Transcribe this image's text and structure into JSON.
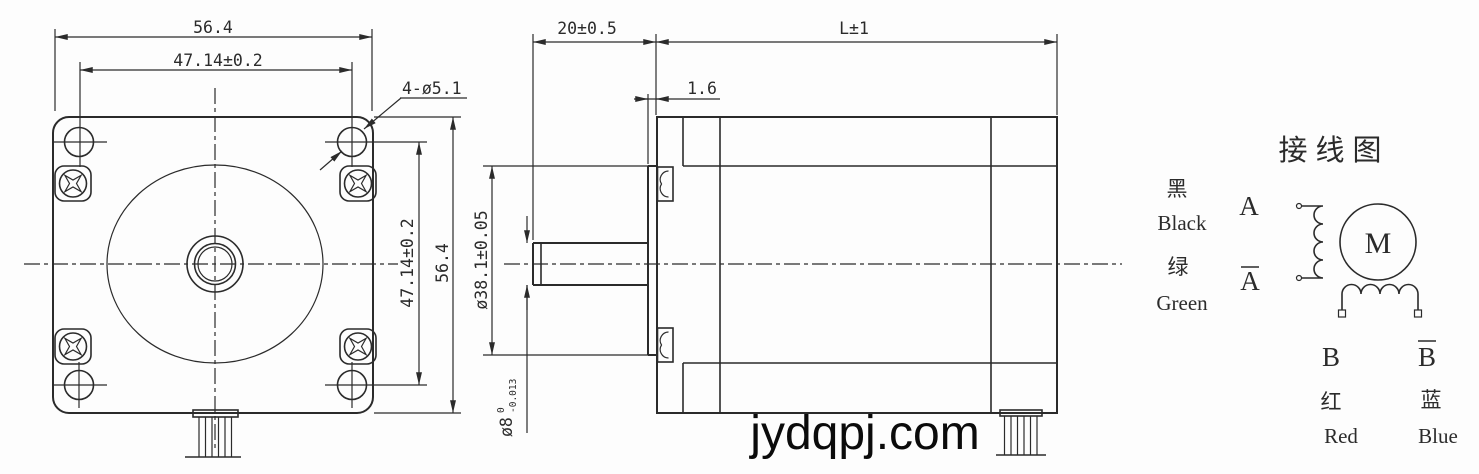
{
  "colors": {
    "line": "#2b2b2b",
    "background": "#fdfdfd",
    "watermark": "#0b0b0b"
  },
  "watermark": "jydqpj.com",
  "front_view": {
    "dim_top_outer": "56.4",
    "dim_top_holes": "47.14±0.2",
    "label_holes": "4-ø5.1",
    "dim_right_holes": "47.14±0.2",
    "dim_right_outer": "56.4"
  },
  "side_view": {
    "dim_shaft_length": "20±0.5",
    "dim_body_length": "L±1",
    "dim_boss_height": "1.6",
    "dim_boss_dia": "ø38.1±0.05",
    "dim_shaft_dia": "ø8",
    "shaft_tol_upper": "0",
    "shaft_tol_lower": "-0.013"
  },
  "wiring": {
    "title": "接线图",
    "motor": "M",
    "terminals": {
      "a": {
        "phase": "A",
        "wire_cn": "黑",
        "wire_en": "Black"
      },
      "a_bar": {
        "phase": "A",
        "wire_cn": "绿",
        "wire_en": "Green"
      },
      "b": {
        "phase": "B",
        "wire_cn": "红",
        "wire_en": "Red"
      },
      "b_bar": {
        "phase": "B",
        "wire_cn": "蓝",
        "wire_en": "Blue"
      }
    }
  }
}
